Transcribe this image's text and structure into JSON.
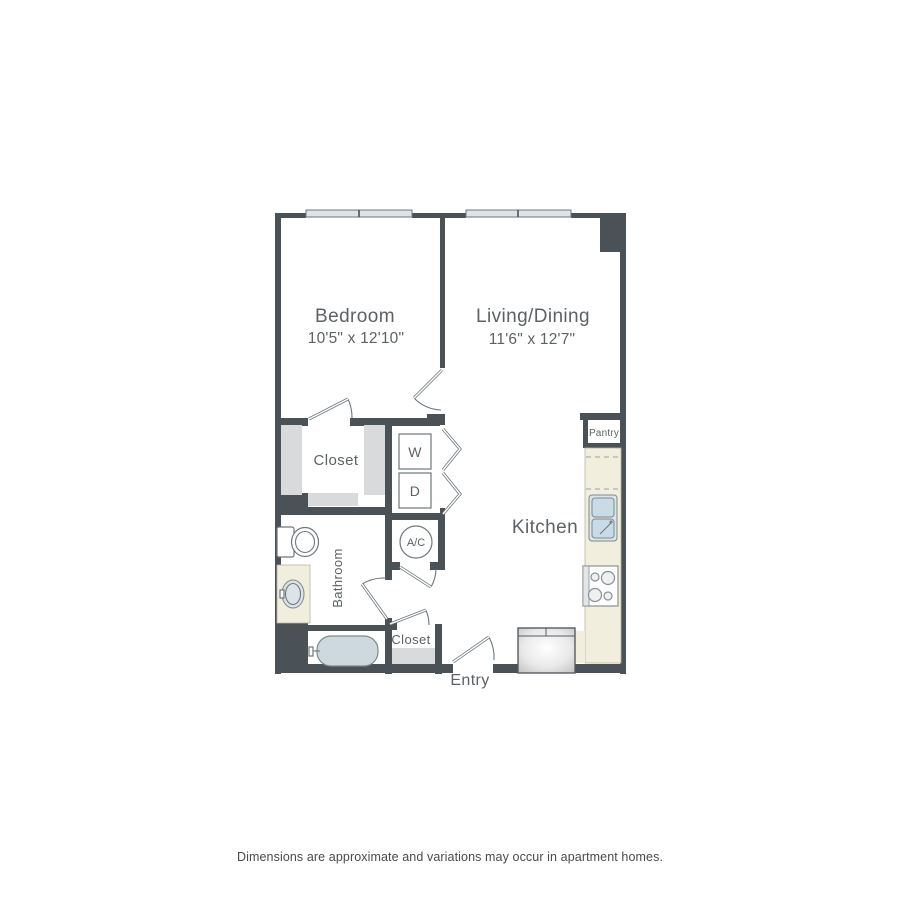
{
  "colors": {
    "wall": "#4a5157",
    "window": "#dde3e7",
    "counter": "#f1eede",
    "tub": "#cdd9df",
    "sink": "#c8dce8",
    "shelf": "#d8dadc",
    "line": "#6f777c",
    "text": "#5c6265"
  },
  "floorplan": {
    "bedroom_label": "Bedroom",
    "bedroom_dims": "10'5\" x 12'10\"",
    "living_label": "Living/Dining",
    "living_dims": "11'6\" x 12'7\"",
    "kitchen_label": "Kitchen",
    "bathroom_label": "Bathroom",
    "closet_label": "Closet",
    "entry_closet_label": "Closet",
    "pantry_label": "Pantry",
    "entry_label": "Entry",
    "washer_label": "W",
    "dryer_label": "D",
    "ac_label": "A/C"
  },
  "footer": {
    "disclaimer": "Dimensions are approximate and variations may occur in apartment homes."
  }
}
